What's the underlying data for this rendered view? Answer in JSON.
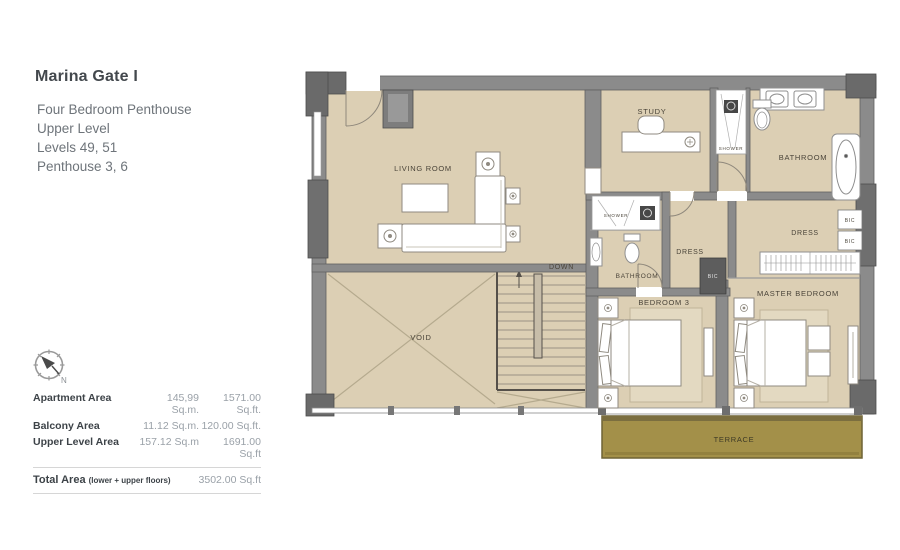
{
  "header": {
    "title": "Marina Gate I",
    "lines": [
      "Four Bedroom Penthouse",
      "Upper Level",
      "Levels 49, 51",
      "Penthouse 3, 6"
    ]
  },
  "compass": {
    "north_label": "N"
  },
  "area_table": {
    "rows": [
      {
        "label": "Apartment Area",
        "sqm": "145,99 Sq.m.",
        "sqft": "1571.00 Sq.ft."
      },
      {
        "label": "Balcony Area",
        "sqm": "11.12 Sq.m.",
        "sqft": "120.00 Sq.ft."
      },
      {
        "label": "Upper Level Area",
        "sqm": "157.12 Sq.m",
        "sqft": "1691.00 Sq.ft"
      }
    ],
    "total": {
      "label": "Total Area",
      "note": "(lower + upper floors)",
      "value": "3502.00 Sq.ft"
    }
  },
  "plan": {
    "labels": {
      "living_room": "LIVING ROOM",
      "down": "DOWN",
      "void": "VOID",
      "study": "STUDY",
      "shower_master": "SHOWER",
      "bathroom_master": "BATHROOM",
      "shower_bed3": "SHOWER",
      "bathroom_bed3": "BATHROOM",
      "dress_bed3": "DRESS",
      "dress_master": "DRESS",
      "bic_bed3": "BIC",
      "bic_master_1": "BIC",
      "bic_master_2": "BIC",
      "bedroom3": "BEDROOM 3",
      "master_bedroom": "MASTER BEDROOM",
      "terrace": "TERRACE"
    },
    "colors": {
      "floor": "#dccfb4",
      "terrace": "#a39049",
      "wall": "#8b8b8b",
      "wall_dark": "#6a6a6a",
      "label_text": "#4a4439"
    }
  }
}
